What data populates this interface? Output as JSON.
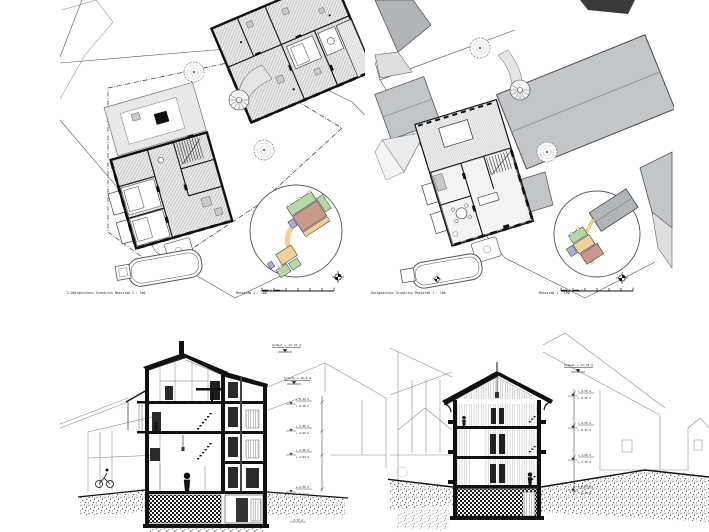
{
  "sheet": {
    "background": "#ffffff",
    "type": "architectural-drawing-sheet"
  },
  "plans": {
    "upper_floor": {
      "caption": "2.Obergeschoss Grundriss Massstab 1 : 100",
      "scale_label": "Massstab 1 : 100"
    },
    "roof_level": {
      "caption": "Dachgeschoss Grundriss Massstab 1 : 100",
      "scale_label": "Massstab 1 : 100"
    }
  },
  "sections": {
    "left": {
      "ridge_label": "Giebel + 13.75 m",
      "eaves_label": "Traufe + 10.5 m",
      "levels": [
        "+ 8.42 m",
        "+ 8.20 m",
        "+ 5.88 m",
        "+ 5.66 m",
        "+ 3.06 m",
        "+ 2.84 m",
        "± 0.00 m",
        "- 0.22 m",
        "- 2.75 m"
      ]
    },
    "right": {
      "ridge_label": "Giebel + 13.70 m",
      "levels": [
        "+ 9.50 m",
        "+ 9.28 m",
        "+ 6.55 m",
        "+ 6.33 m",
        "+ 3.60 m",
        "+ 3.38 m",
        "± 0.00 m",
        "- 0.22 m"
      ]
    }
  },
  "icons": {
    "north": "crosshair-survey-point",
    "tree": "scribble-tree",
    "person": "human-silhouette",
    "spiral_stair": "spiral-stair",
    "scale_bar": "graduated-scale-bar"
  },
  "palette": {
    "roof_gray": "#c3c6c8",
    "roof_gray_dark": "#b2b5b7",
    "roof_gray_light": "#dcdedf",
    "green": "#b7d7a8",
    "salmon": "#c9998c",
    "orange": "#f0d09a",
    "purple": "#a9aed6",
    "ink": "#111111"
  }
}
